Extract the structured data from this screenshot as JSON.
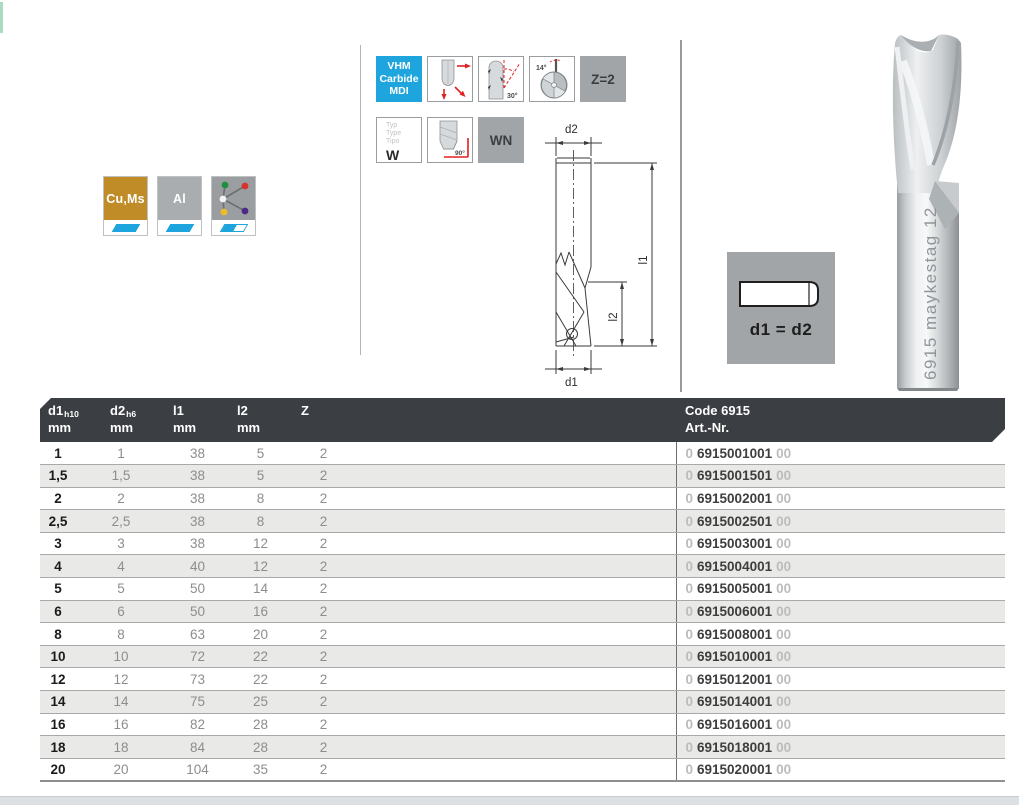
{
  "colors": {
    "accent_blue": "#1ea5dd",
    "brass": "#c08c28",
    "panel_gray": "#a2a5a8",
    "header_dark": "#3b3e42",
    "row_stripe": "#e9e9e7",
    "arrow_red": "#e02020"
  },
  "materials": [
    {
      "label": "Cu,Ms",
      "suitability": "full"
    },
    {
      "label": "Al",
      "suitability": "full"
    },
    {
      "label": "",
      "suitability": "half",
      "icon": "material-network-icon"
    }
  ],
  "pictograms": {
    "vhm_lines": [
      "VHM",
      "Carbide",
      "MDI"
    ],
    "angle_30": "30°",
    "angle_14": "14°",
    "angle_90": "90°",
    "z_label": "Z=2",
    "wn_label": "WN",
    "typ_lines": [
      "Typ",
      "Type",
      "Tipo"
    ],
    "typ_value": "W"
  },
  "diagram": {
    "d2": "d2",
    "l1": "l1",
    "l2": "l2",
    "d1": "d1"
  },
  "equal_box": {
    "label": "d1 = d2"
  },
  "photo": {
    "engraving": "6915 maykestag 12"
  },
  "table": {
    "columns": [
      {
        "main": "d1",
        "sub": "h10",
        "unit": "mm"
      },
      {
        "main": "d2",
        "sub": "h6",
        "unit": "mm"
      },
      {
        "main": "l1",
        "sub": "",
        "unit": "mm"
      },
      {
        "main": "l2",
        "sub": "",
        "unit": "mm"
      },
      {
        "main": "Z",
        "sub": "",
        "unit": ""
      }
    ],
    "code": {
      "line1": "Code 6915",
      "line2": "Art.-Nr."
    },
    "rows": [
      {
        "d1": "1",
        "d2": "1",
        "l1": "38",
        "l2": "5",
        "z": "2",
        "art_prefix": "0",
        "art": "6915001001",
        "art_suffix": "00"
      },
      {
        "d1": "1,5",
        "d2": "1,5",
        "l1": "38",
        "l2": "5",
        "z": "2",
        "art_prefix": "0",
        "art": "6915001501",
        "art_suffix": "00"
      },
      {
        "d1": "2",
        "d2": "2",
        "l1": "38",
        "l2": "8",
        "z": "2",
        "art_prefix": "0",
        "art": "6915002001",
        "art_suffix": "00"
      },
      {
        "d1": "2,5",
        "d2": "2,5",
        "l1": "38",
        "l2": "8",
        "z": "2",
        "art_prefix": "0",
        "art": "6915002501",
        "art_suffix": "00"
      },
      {
        "d1": "3",
        "d2": "3",
        "l1": "38",
        "l2": "12",
        "z": "2",
        "art_prefix": "0",
        "art": "6915003001",
        "art_suffix": "00"
      },
      {
        "d1": "4",
        "d2": "4",
        "l1": "40",
        "l2": "12",
        "z": "2",
        "art_prefix": "0",
        "art": "6915004001",
        "art_suffix": "00"
      },
      {
        "d1": "5",
        "d2": "5",
        "l1": "50",
        "l2": "14",
        "z": "2",
        "art_prefix": "0",
        "art": "6915005001",
        "art_suffix": "00"
      },
      {
        "d1": "6",
        "d2": "6",
        "l1": "50",
        "l2": "16",
        "z": "2",
        "art_prefix": "0",
        "art": "6915006001",
        "art_suffix": "00"
      },
      {
        "d1": "8",
        "d2": "8",
        "l1": "63",
        "l2": "20",
        "z": "2",
        "art_prefix": "0",
        "art": "6915008001",
        "art_suffix": "00"
      },
      {
        "d1": "10",
        "d2": "10",
        "l1": "72",
        "l2": "22",
        "z": "2",
        "art_prefix": "0",
        "art": "6915010001",
        "art_suffix": "00"
      },
      {
        "d1": "12",
        "d2": "12",
        "l1": "73",
        "l2": "22",
        "z": "2",
        "art_prefix": "0",
        "art": "6915012001",
        "art_suffix": "00"
      },
      {
        "d1": "14",
        "d2": "14",
        "l1": "75",
        "l2": "25",
        "z": "2",
        "art_prefix": "0",
        "art": "6915014001",
        "art_suffix": "00"
      },
      {
        "d1": "16",
        "d2": "16",
        "l1": "82",
        "l2": "28",
        "z": "2",
        "art_prefix": "0",
        "art": "6915016001",
        "art_suffix": "00"
      },
      {
        "d1": "18",
        "d2": "18",
        "l1": "84",
        "l2": "28",
        "z": "2",
        "art_prefix": "0",
        "art": "6915018001",
        "art_suffix": "00"
      },
      {
        "d1": "20",
        "d2": "20",
        "l1": "104",
        "l2": "35",
        "z": "2",
        "art_prefix": "0",
        "art": "6915020001",
        "art_suffix": "00"
      }
    ]
  }
}
